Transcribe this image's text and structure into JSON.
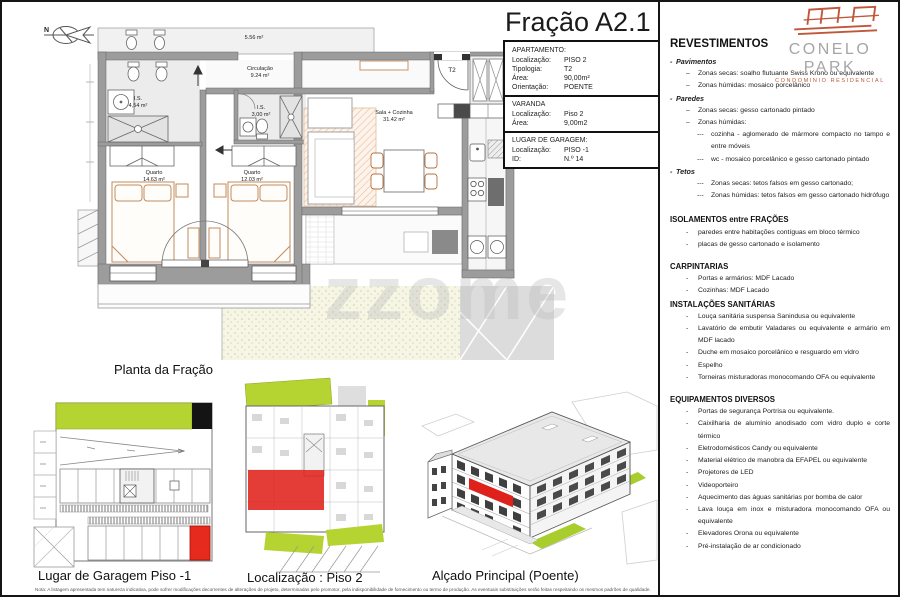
{
  "page": {
    "watermark": "zzome",
    "note": "Nota: A listagem apresentada tem natureza indicativa, pode sofrer modificações decorrentes de alterações de projeto, determinadas pelo promotor, pela indisponibilidade de fornecimento ou termo de produção. As eventuais substituições serão feitas respeitando os mesmos padrões de qualidade."
  },
  "title": "Fração A2.1",
  "info": {
    "apartment": {
      "heading": "APARTAMENTO:",
      "rows": [
        {
          "label": "Localização:",
          "value": "PISO 2"
        },
        {
          "label": "Tipologia:",
          "value": "T2"
        },
        {
          "label": "Área:",
          "value": "90,00m²"
        },
        {
          "label": "Orientação:",
          "value": "POENTE"
        }
      ]
    },
    "balcony": {
      "heading": "VARANDA",
      "rows": [
        {
          "label": "Localização:",
          "value": "Piso 2"
        },
        {
          "label": "Área:",
          "value": "9,00m2"
        }
      ]
    },
    "garage": {
      "heading": "LUGAR DE GARAGEM:",
      "rows": [
        {
          "label": "Localização:",
          "value": "PISO -1"
        },
        {
          "label": "ID:",
          "value": "N.º 14"
        }
      ]
    }
  },
  "plan": {
    "north_label": "N",
    "rooms": {
      "hall_area": "5.56 m²",
      "circ_name": "Circulação",
      "circ_area": "9.24 m²",
      "is1_name": "I.S.",
      "is1_area": "4,54 m²",
      "is2_name": "I.S.",
      "is2_area": "3,00 m²",
      "q1_name": "Quarto",
      "q1_area": "14.63 m²",
      "q2_name": "Quarto",
      "q2_area": "12.03 m²",
      "sala_name": "Sala + Cozinha",
      "sala_area": "31.42 m²",
      "entry_tag": "T2"
    },
    "caption": "Planta da Fração"
  },
  "figures": {
    "garage_caption": "Lugar de Garagem Piso -1",
    "location_caption": "Localização : Piso 2",
    "elevation_caption": "Alçado Principal (Poente)"
  },
  "brand": {
    "name": "CONELO PARK",
    "tagline": "CONDOMINIO RESIDENCIAL",
    "accent": "#c0563a",
    "highlight_red": "#e0211b",
    "grass_green": "#b5d331"
  },
  "specs": {
    "title": "REVESTIMENTOS",
    "dash": "-",
    "rev": [
      {
        "b": "-",
        "t": "Pavimentos"
      },
      {
        "b": "–",
        "t": "Zonas secas: soalho flutuante Swiss Krono ou equivalente"
      },
      {
        "b": "–",
        "t": "Zonas húmidas: mosaico porcelânico"
      },
      {
        "b": "-",
        "t": "Paredes"
      },
      {
        "b": "–",
        "t": "Zonas secas: gesso cartonado pintado"
      },
      {
        "b": "–",
        "t": "Zonas húmidas:"
      },
      {
        "b": "---",
        "t": "cozinha - aglomerado de mármore compacto no tampo e entre móveis"
      },
      {
        "b": "---",
        "t": "wc - mosaico porcelânico e gesso cartonado pintado"
      },
      {
        "b": "-",
        "t": "Tetos"
      },
      {
        "b": "---",
        "t": "Zonas secas: tetos falsos em gesso cartonado;"
      },
      {
        "b": "---",
        "t": "Zonas húmidas: tetos falsos em gesso cartonado hidrófugo"
      }
    ],
    "iso": {
      "title": "ISOLAMENTOS entre FRAÇÕES",
      "items": [
        "paredes entre habitações contíguas em bloco térmico",
        "placas de gesso cartonado e isolamento"
      ]
    },
    "carp": {
      "title": "CARPINTARIAS",
      "items": [
        "Portas e armários: MDF Lacado",
        "Cozinhas: MDF Lacado"
      ]
    },
    "inst": {
      "title": "INSTALAÇÕES SANITÁRIAS",
      "items": [
        "Louça sanitária suspensa Sanindusa ou equivalente",
        "Lavatório de embutir Valadares ou equivalente e armário em MDF lacado",
        "Duche em mosaico porcelânico e resguardo em vidro",
        "Espelho",
        "Torneiras misturadoras monocomando OFA ou equivalente"
      ]
    },
    "equip": {
      "title": "EQUIPAMENTOS DIVERSOS",
      "items": [
        "Portas de segurança Portrisa ou equivalente.",
        "Caixilharia de alumínio anodisado com vidro duplo e corte térmico",
        "Eletrodomésticos Candy ou equivalente",
        "Material elétrico de manobra da EFAPEL ou equivalente",
        "Projetores de LED",
        "Videoporteiro",
        "Aquecimento das águas sanitárias por bomba de calor",
        "Lava louça em inox e misturadora monocomando OFA ou equivalente",
        "Elevadores Orona ou equivalente",
        "Pré-instalação de ar condicionado"
      ]
    }
  }
}
